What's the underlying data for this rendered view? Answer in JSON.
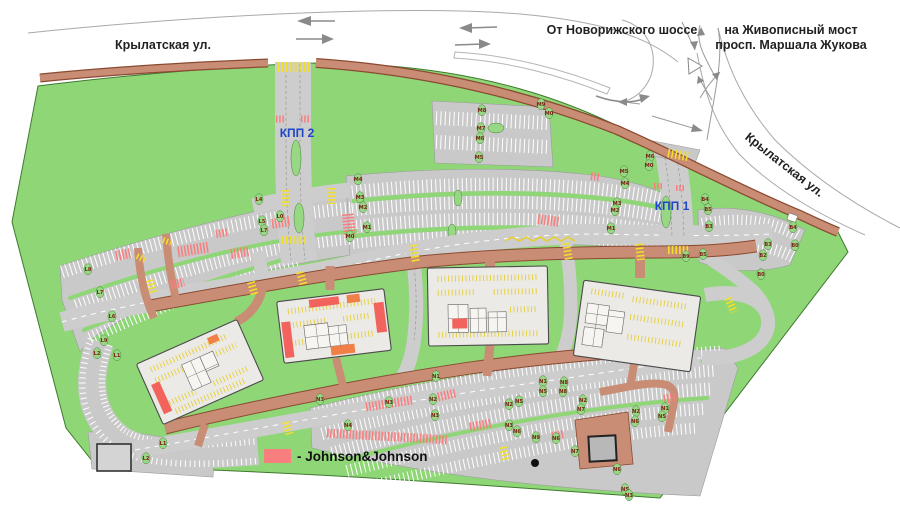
{
  "map": {
    "streets": {
      "krylatskaya_left": "Крылатская ул.",
      "from_novorizhskoye": "От Новорижского шоссе",
      "to_zhivopisny_line1": "на Живописный мост",
      "to_zhivopisny_line2": "просп. Маршала Жукова",
      "krylatskaya_right": "Крылатская ул."
    },
    "checkpoints": {
      "kpp1": "КПП 1",
      "kpp2": "КПП 2"
    },
    "legend": {
      "swatch_color": "#f97e7e",
      "label": "- Johnson&Johnson"
    },
    "colors": {
      "site_green": "#8fd677",
      "parking_gray": "#c9c9c9",
      "road_brown": "#c88d74",
      "building_gray": "#eceae6",
      "jnj_red": "#f97e7e",
      "marking_yellow": "#f2df2b",
      "checkpoint_blue": "#1d46c8",
      "row_label_maroon": "#7c1d17"
    },
    "parking_row_labels": [
      {
        "t": "M8",
        "x": 482,
        "y": 112
      },
      {
        "t": "M9",
        "x": 541,
        "y": 106
      },
      {
        "t": "M0",
        "x": 549,
        "y": 115
      },
      {
        "t": "M7",
        "x": 481,
        "y": 130
      },
      {
        "t": "M6",
        "x": 480,
        "y": 140
      },
      {
        "t": "M5",
        "x": 479,
        "y": 159
      },
      {
        "t": "M6",
        "x": 650,
        "y": 158
      },
      {
        "t": "M0",
        "x": 649,
        "y": 167
      },
      {
        "t": "M5",
        "x": 624,
        "y": 173
      },
      {
        "t": "M4",
        "x": 625,
        "y": 185
      },
      {
        "t": "M3",
        "x": 617,
        "y": 205
      },
      {
        "t": "M2",
        "x": 615,
        "y": 212
      },
      {
        "t": "M1",
        "x": 611,
        "y": 230
      },
      {
        "t": "M4",
        "x": 358,
        "y": 181
      },
      {
        "t": "M3",
        "x": 360,
        "y": 199
      },
      {
        "t": "M2",
        "x": 363,
        "y": 209
      },
      {
        "t": "M1",
        "x": 367,
        "y": 229
      },
      {
        "t": "M0",
        "x": 350,
        "y": 238
      },
      {
        "t": "L4",
        "x": 259,
        "y": 201
      },
      {
        "t": "L0",
        "x": 280,
        "y": 218
      },
      {
        "t": "L5",
        "x": 262,
        "y": 223
      },
      {
        "t": "L7",
        "x": 264,
        "y": 232
      },
      {
        "t": "L8",
        "x": 88,
        "y": 271
      },
      {
        "t": "L7",
        "x": 100,
        "y": 294
      },
      {
        "t": "L6",
        "x": 112,
        "y": 318
      },
      {
        "t": "L9",
        "x": 104,
        "y": 342
      },
      {
        "t": "L2",
        "x": 97,
        "y": 355
      },
      {
        "t": "L1",
        "x": 117,
        "y": 357
      },
      {
        "t": "L1",
        "x": 163,
        "y": 445
      },
      {
        "t": "L2",
        "x": 146,
        "y": 460
      },
      {
        "t": "N1",
        "x": 436,
        "y": 378
      },
      {
        "t": "N2",
        "x": 433,
        "y": 401
      },
      {
        "t": "N3",
        "x": 435,
        "y": 417
      },
      {
        "t": "N3",
        "x": 320,
        "y": 401
      },
      {
        "t": "N3",
        "x": 389,
        "y": 404
      },
      {
        "t": "N4",
        "x": 348,
        "y": 427
      },
      {
        "t": "N5",
        "x": 519,
        "y": 403
      },
      {
        "t": "N2",
        "x": 509,
        "y": 406
      },
      {
        "t": "N3",
        "x": 509,
        "y": 427
      },
      {
        "t": "N6",
        "x": 517,
        "y": 433
      },
      {
        "t": "N1",
        "x": 543,
        "y": 383
      },
      {
        "t": "N5",
        "x": 543,
        "y": 393
      },
      {
        "t": "N8",
        "x": 564,
        "y": 384
      },
      {
        "t": "N8",
        "x": 563,
        "y": 393
      },
      {
        "t": "N9",
        "x": 536,
        "y": 439
      },
      {
        "t": "N6",
        "x": 556,
        "y": 440
      },
      {
        "t": "N2",
        "x": 583,
        "y": 402
      },
      {
        "t": "N7",
        "x": 581,
        "y": 411
      },
      {
        "t": "N7",
        "x": 575,
        "y": 453
      },
      {
        "t": "N6",
        "x": 617,
        "y": 471
      },
      {
        "t": "N2",
        "x": 636,
        "y": 413
      },
      {
        "t": "N6",
        "x": 635,
        "y": 423
      },
      {
        "t": "N1",
        "x": 665,
        "y": 410
      },
      {
        "t": "N5",
        "x": 662,
        "y": 418
      },
      {
        "t": "N5",
        "x": 625,
        "y": 491
      },
      {
        "t": "N3",
        "x": 629,
        "y": 497
      },
      {
        "t": "B4",
        "x": 705,
        "y": 201
      },
      {
        "t": "B5",
        "x": 708,
        "y": 211
      },
      {
        "t": "B3",
        "x": 709,
        "y": 228
      },
      {
        "t": "B3",
        "x": 768,
        "y": 246
      },
      {
        "t": "B2",
        "x": 763,
        "y": 257
      },
      {
        "t": "B4",
        "x": 793,
        "y": 229
      },
      {
        "t": "B0",
        "x": 795,
        "y": 247
      },
      {
        "t": "B5",
        "x": 703,
        "y": 256
      },
      {
        "t": "B9",
        "x": 686,
        "y": 258
      },
      {
        "t": "B0",
        "x": 761,
        "y": 276
      }
    ]
  }
}
